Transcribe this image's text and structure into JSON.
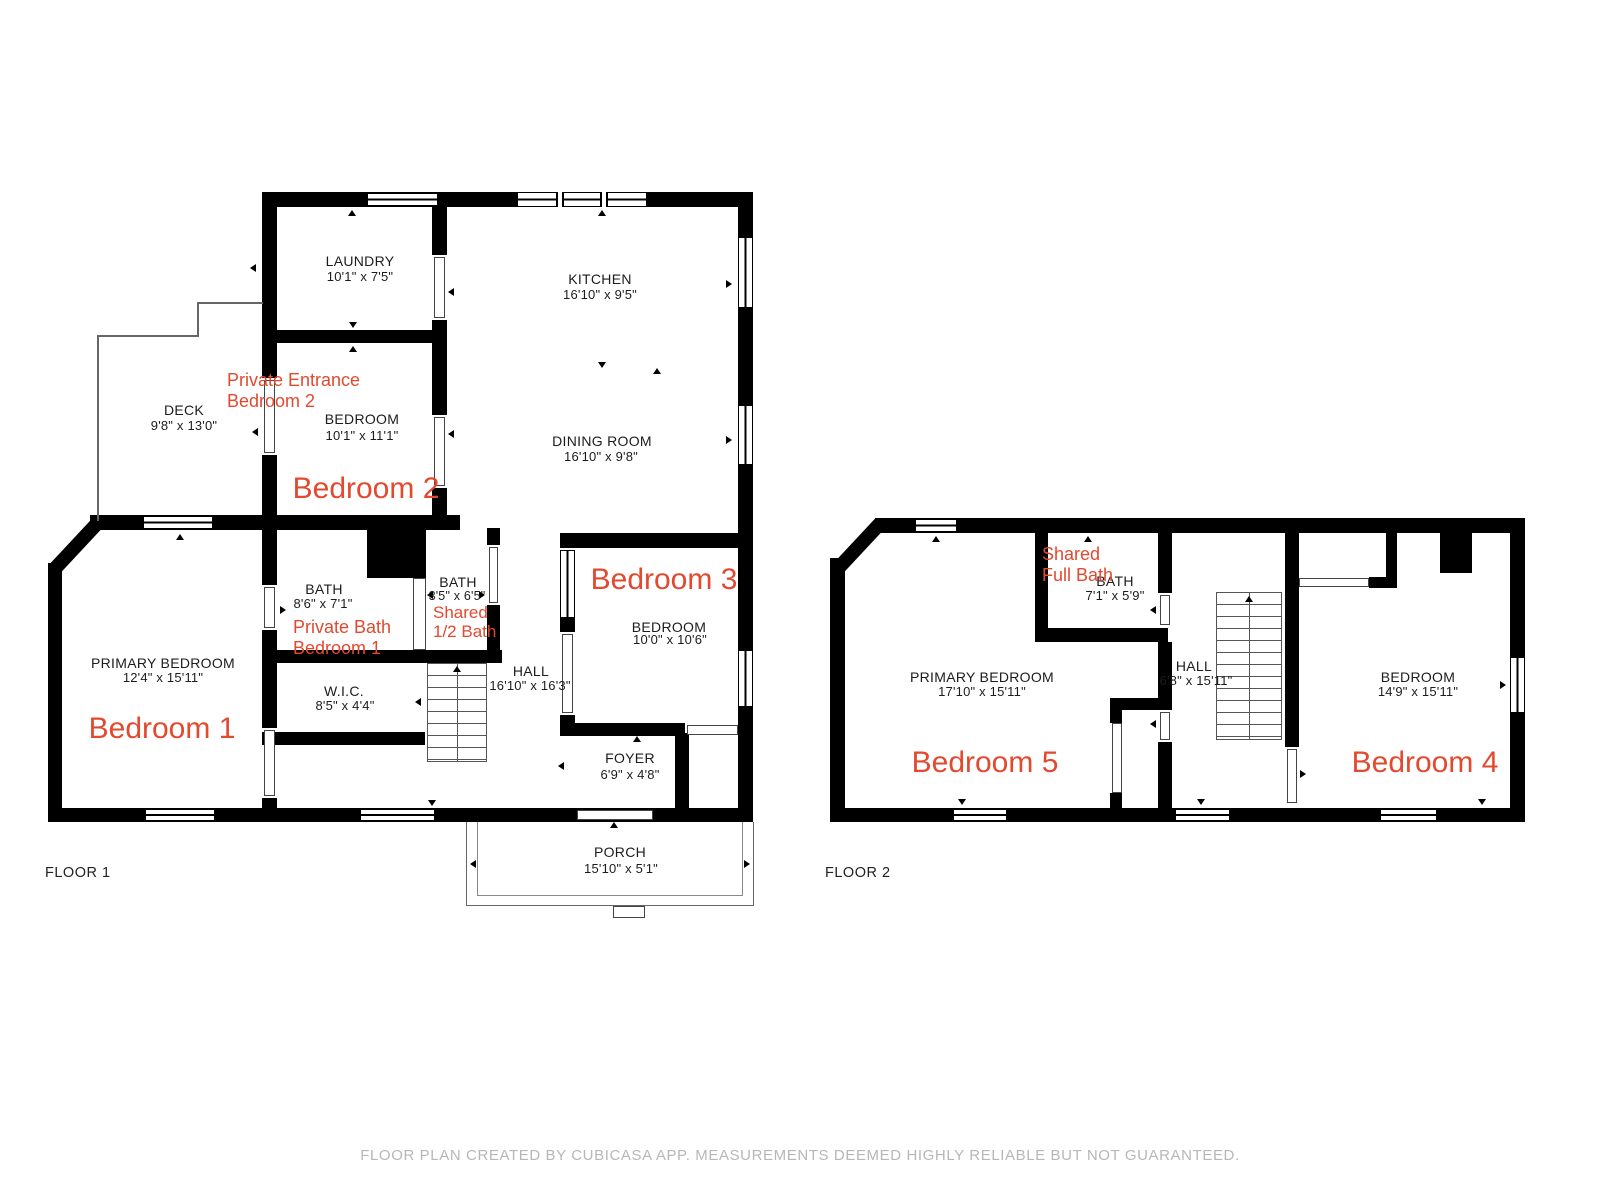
{
  "page": {
    "floor1_caption": "FLOOR 1",
    "floor2_caption": "FLOOR 2",
    "disclaimer": "FLOOR PLAN CREATED BY CUBICASA APP. MEASUREMENTS DEEMED HIGHLY RELIABLE BUT NOT GUARANTEED."
  },
  "colors": {
    "wall": "#000000",
    "annotation_red": "#e2492f",
    "label_black": "#1c1c1c",
    "disclaimer_gray": "#b7b7b7"
  },
  "floor1": {
    "rooms": {
      "laundry": {
        "name": "LAUNDRY",
        "dims": "10'1\" x 7'5\""
      },
      "kitchen": {
        "name": "KITCHEN",
        "dims": "16'10\" x 9'5\""
      },
      "dining_room": {
        "name": "DINING ROOM",
        "dims": "16'10\" x 9'8\""
      },
      "deck": {
        "name": "DECK",
        "dims": "9'8\" x 13'0\""
      },
      "bedroom2": {
        "name": "BEDROOM",
        "dims": "10'1\" x 11'1\""
      },
      "primary_bedroom": {
        "name": "PRIMARY BEDROOM",
        "dims": "12'4\" x 15'11\""
      },
      "bath_private": {
        "name": "BATH",
        "dims": "8'6\" x 7'1\""
      },
      "wic": {
        "name": "W.I.C.",
        "dims": "8'5\" x 4'4\""
      },
      "bath_half": {
        "name": "BATH",
        "dims": "3'5\" x 6'5\""
      },
      "hall": {
        "name": "HALL",
        "dims": "16'10\" x 16'3\""
      },
      "bedroom3": {
        "name": "BEDROOM",
        "dims": "10'0\" x 10'6\""
      },
      "foyer": {
        "name": "FOYER",
        "dims": "6'9\" x 4'8\""
      },
      "porch": {
        "name": "PORCH",
        "dims": "15'10\" x 5'1\""
      }
    },
    "annotations": {
      "bedroom1_tag": "Bedroom 1",
      "bedroom2_tag": "Bedroom 2",
      "bedroom3_tag": "Bedroom 3",
      "private_entrance_line1": "Private Entrance",
      "private_entrance_line2": "Bedroom 2",
      "private_bath_line1": "Private Bath",
      "private_bath_line2": "Bedroom 1",
      "shared_half_line1": "Shared",
      "shared_half_line2": "1/2 Bath"
    }
  },
  "floor2": {
    "rooms": {
      "bath": {
        "name": "BATH",
        "dims": "7'1\" x 5'9\""
      },
      "primary_bedroom": {
        "name": "PRIMARY BEDROOM",
        "dims": "17'10\" x 15'11\""
      },
      "hall": {
        "name": "HALL",
        "dims": "6'8\" x 15'11\""
      },
      "bedroom4": {
        "name": "BEDROOM",
        "dims": "14'9\" x 15'11\""
      }
    },
    "annotations": {
      "bedroom4_tag": "Bedroom 4",
      "bedroom5_tag": "Bedroom 5",
      "shared_full_line1": "Shared",
      "shared_full_line2": "Full Bath"
    }
  }
}
